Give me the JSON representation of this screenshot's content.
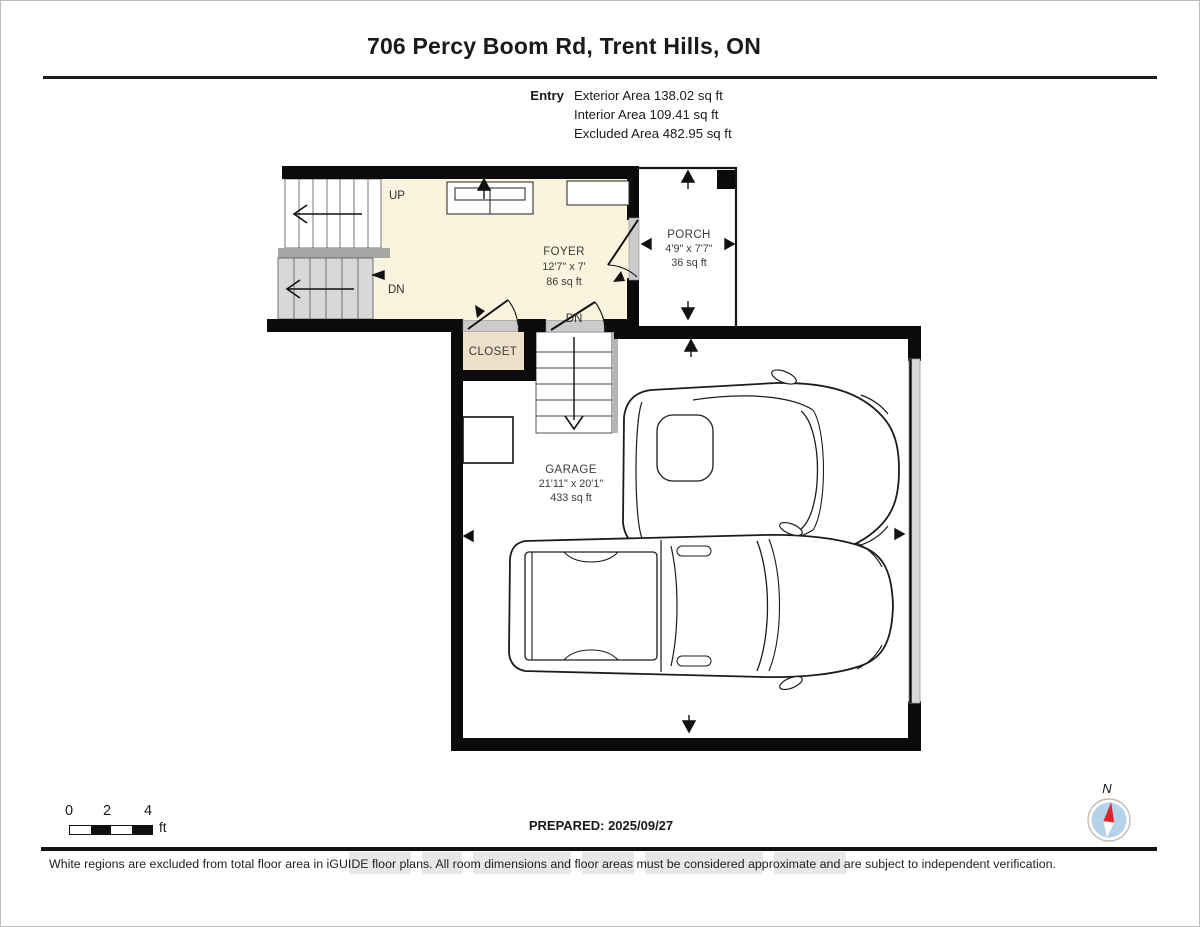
{
  "header": {
    "title": "706 Percy Boom Rd, Trent Hills, ON",
    "floor_label": "Entry",
    "stats": {
      "exterior": "Exterior Area 138.02 sq ft",
      "interior": "Interior Area 109.41 sq ft",
      "excluded": "Excluded Area 482.95 sq ft"
    }
  },
  "plan": {
    "foyer": {
      "name": "FOYER",
      "dims": "12'7\" x 7'",
      "area": "86 sq ft"
    },
    "porch": {
      "name": "PORCH",
      "dims": "4'9\" x 7'7\"",
      "area": "36 sq ft"
    },
    "garage": {
      "name": "GARAGE",
      "dims": "21'11\" x 20'1\"",
      "area": "433 sq ft"
    },
    "closet": {
      "name": "CLOSET"
    },
    "stairs": {
      "up": "UP",
      "dn": "DN"
    },
    "door_dn": "DN",
    "colors": {
      "interior_fill": "#faf4de",
      "excluded_fill": "#ffffff",
      "closet_fill": "#ede0c8",
      "stair_gray": "#d8d8d8",
      "landing_gray": "#a6a6a6",
      "door_jamb_gray": "#cbcbcb",
      "wall": "#0b0b0b",
      "compass_blue": "#b5d2eb",
      "compass_red": "#e02127"
    }
  },
  "footer": {
    "scale": {
      "ticks": [
        "0",
        "2",
        "4"
      ],
      "unit": "ft"
    },
    "prepared": "PREPARED: 2025/09/27",
    "compass_n": "N",
    "disclaimer": "White regions are excluded from total floor area in iGUIDE floor plans. All room dimensions and floor areas must be considered approximate and are subject to independent verification."
  }
}
